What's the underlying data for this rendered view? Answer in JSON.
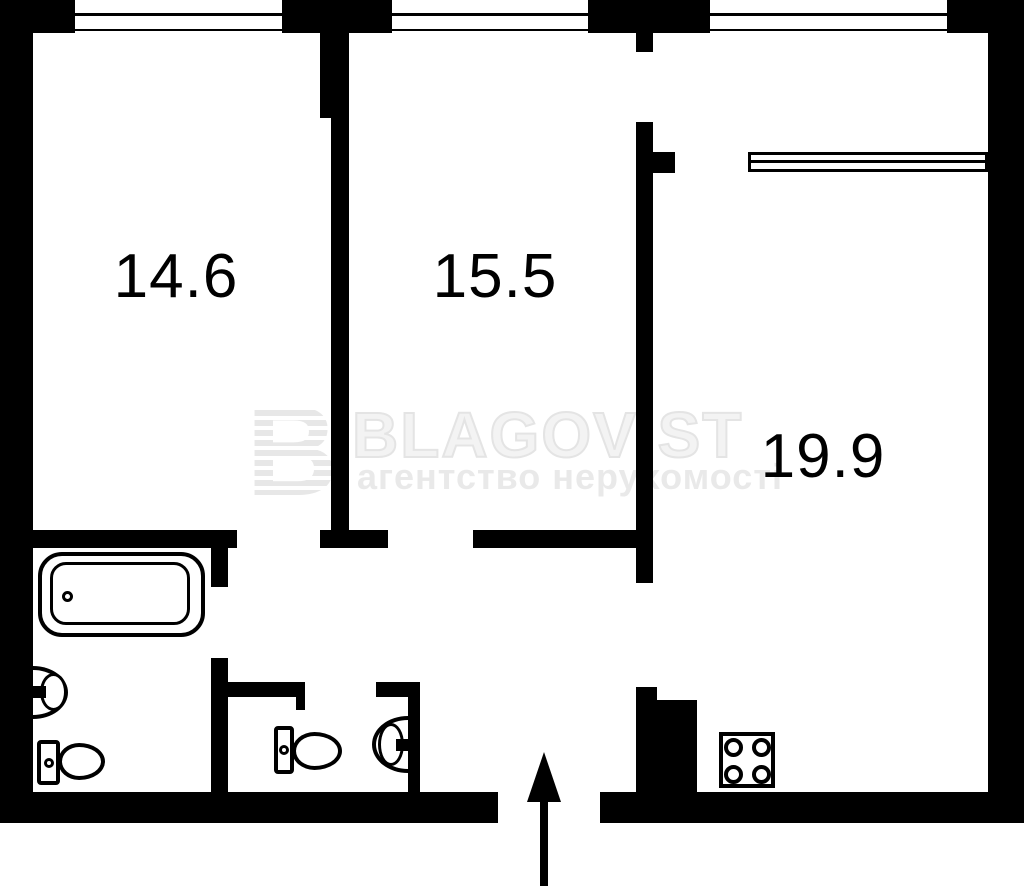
{
  "floor_plan": {
    "rooms": [
      {
        "name": "bedroom-left",
        "area_label": "14.6"
      },
      {
        "name": "bedroom-middle",
        "area_label": "15.5"
      },
      {
        "name": "kitchen-living-room",
        "area_label": "19.9"
      }
    ],
    "watermark": {
      "logo_letter": "B",
      "brand": "BLAGOVIST",
      "tagline": "агентство нерухомості"
    },
    "colors": {
      "wall": "#000000",
      "background": "#ffffff",
      "watermark_gray": "#ececec"
    },
    "icons": [
      "bathtub-icon",
      "sink-icon",
      "toilet-icon",
      "stove-icon",
      "entrance-arrow-icon",
      "window-icon"
    ]
  }
}
